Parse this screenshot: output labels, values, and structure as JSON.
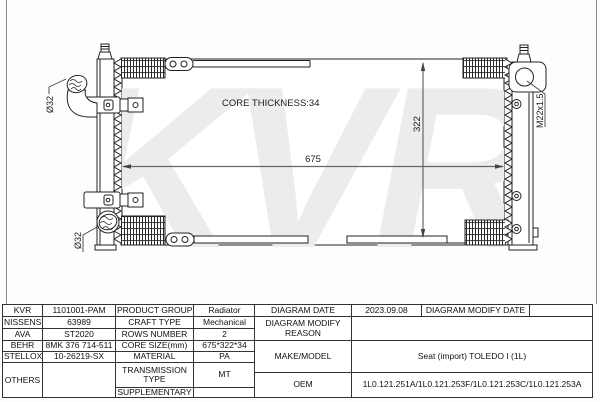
{
  "diagram": {
    "watermark": "KVR",
    "core_thickness": "CORE THICKNESS:34",
    "width_dim": "675",
    "height_dim": "322",
    "inlet_diameter": "Ø32",
    "outlet_diameter": "Ø32",
    "filler_thread": "M22x1.5"
  },
  "table": {
    "crossref": {
      "rows": [
        {
          "brand": "KVR",
          "code": "1101001-PAM"
        },
        {
          "brand": "NISSENS",
          "code": "63989"
        },
        {
          "brand": "AVA",
          "code": "ST2020"
        },
        {
          "brand": "BEHR",
          "code": "8MK 376 714-511"
        },
        {
          "brand": "STELLOX",
          "code": "10-26219-SX"
        },
        {
          "brand": "OTHERS",
          "code": ""
        }
      ]
    },
    "specs": {
      "product_group_label": "PRODUCT GROUP",
      "product_group": "Radiator",
      "craft_type_label": "CRAFT TYPE",
      "craft_type": "Mechanical",
      "rows_number_label": "ROWS NUMBER",
      "rows_number": "2",
      "core_size_label": "CORE SIZE(mm)",
      "core_size": "675*322*34",
      "material_label": "MATERIAL",
      "material": "PA",
      "transmission_label": "TRANSMISSION TYPE",
      "transmission": "MT",
      "supplementary_label": "SUPPLEMENTARY",
      "supplementary": ""
    },
    "info": {
      "diagram_date_label": "DIAGRAM DATE",
      "diagram_date": "2023.09.08",
      "modify_date_label": "DIAGRAM MODIFY DATE",
      "modify_date": "",
      "modify_reason_label": "DIAGRAM MODIFY REASON",
      "modify_reason": "",
      "make_model_label": "MAKE/MODEL",
      "make_model": "Seat (import) TOLEDO I (1L)",
      "oem_label": "OEM",
      "oem": "1L0.121.251A/1L0.121.253F/1L0.121.253C/1L0.121.253A"
    }
  }
}
